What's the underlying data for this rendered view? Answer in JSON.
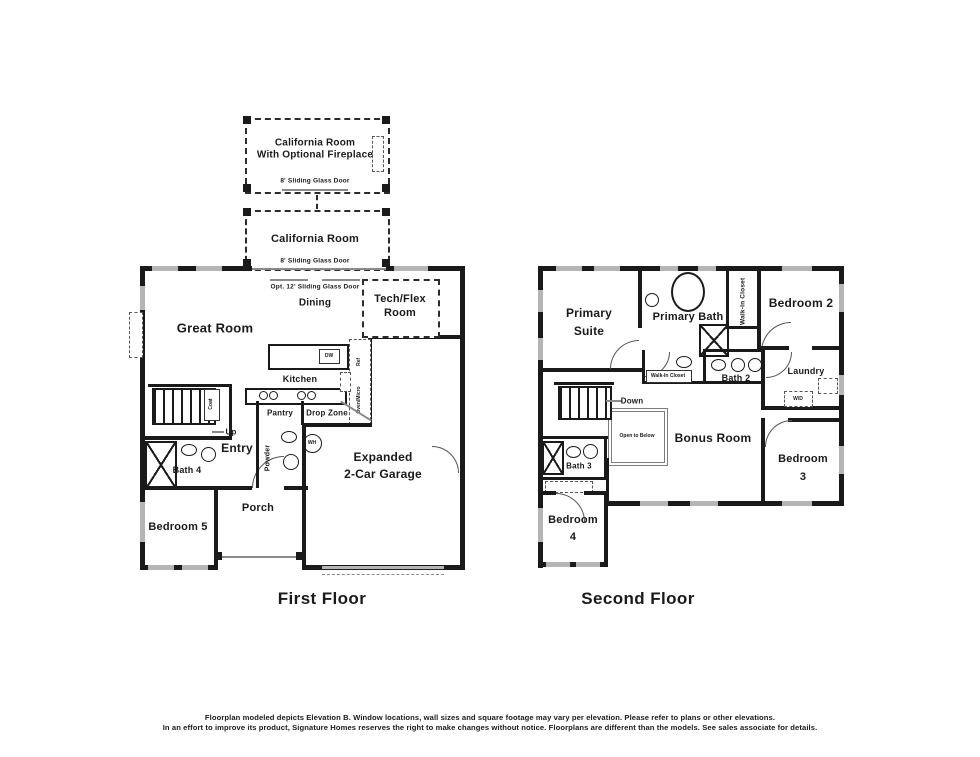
{
  "first_floor": {
    "title": "First Floor",
    "optional_california_room": {
      "name_line1": "California Room",
      "name_line2": "With Optional Fireplace",
      "door": "8' Sliding Glass Door"
    },
    "california_room": {
      "name": "California Room",
      "door": "8' Sliding Glass Door"
    },
    "labels": {
      "opt_sliding_door": "Opt. 12' Sliding Glass Door",
      "dining": "Dining",
      "great_room": "Great Room",
      "tech_flex_line1": "Tech/Flex",
      "tech_flex_line2": "Room",
      "kitchen": "Kitchen",
      "dw": "DW",
      "ref": "Ref",
      "oven_micro": "Oven/Micro",
      "pantry": "Pantry",
      "drop_zone": "Drop Zone",
      "powder": "Powder",
      "wh": "WH",
      "coat": "Coat",
      "up": "Up",
      "entry": "Entry",
      "bath_4": "Bath 4",
      "bedroom_5": "Bedroom 5",
      "porch": "Porch",
      "garage_line1": "Expanded",
      "garage_line2": "2-Car Garage"
    }
  },
  "second_floor": {
    "title": "Second Floor",
    "labels": {
      "primary_suite_line1": "Primary",
      "primary_suite_line2": "Suite",
      "primary_bath": "Primary Bath",
      "walk_in_closet_vertical": "Walk-In Closet",
      "walk_in_closet_small": "Walk-In Closet",
      "bedroom_2": "Bedroom 2",
      "bath_2": "Bath 2",
      "laundry": "Laundry",
      "wd": "W/D",
      "down": "Down",
      "open_to_below": "Open to Below",
      "bonus_room": "Bonus Room",
      "bath_3": "Bath 3",
      "bedroom_4_line1": "Bedroom",
      "bedroom_4_line2": "4",
      "bedroom_3_line1": "Bedroom",
      "bedroom_3_line2": "3"
    }
  },
  "footer": {
    "line1": "Floorplan modeled depicts Elevation B. Window locations, wall sizes and square footage may vary per elevation. Please refer to plans or other elevations.",
    "line2": "In an effort to improve its product, Signature Homes reserves the right to make changes without notice. Floorplans are different than the models. See sales associate for details."
  }
}
